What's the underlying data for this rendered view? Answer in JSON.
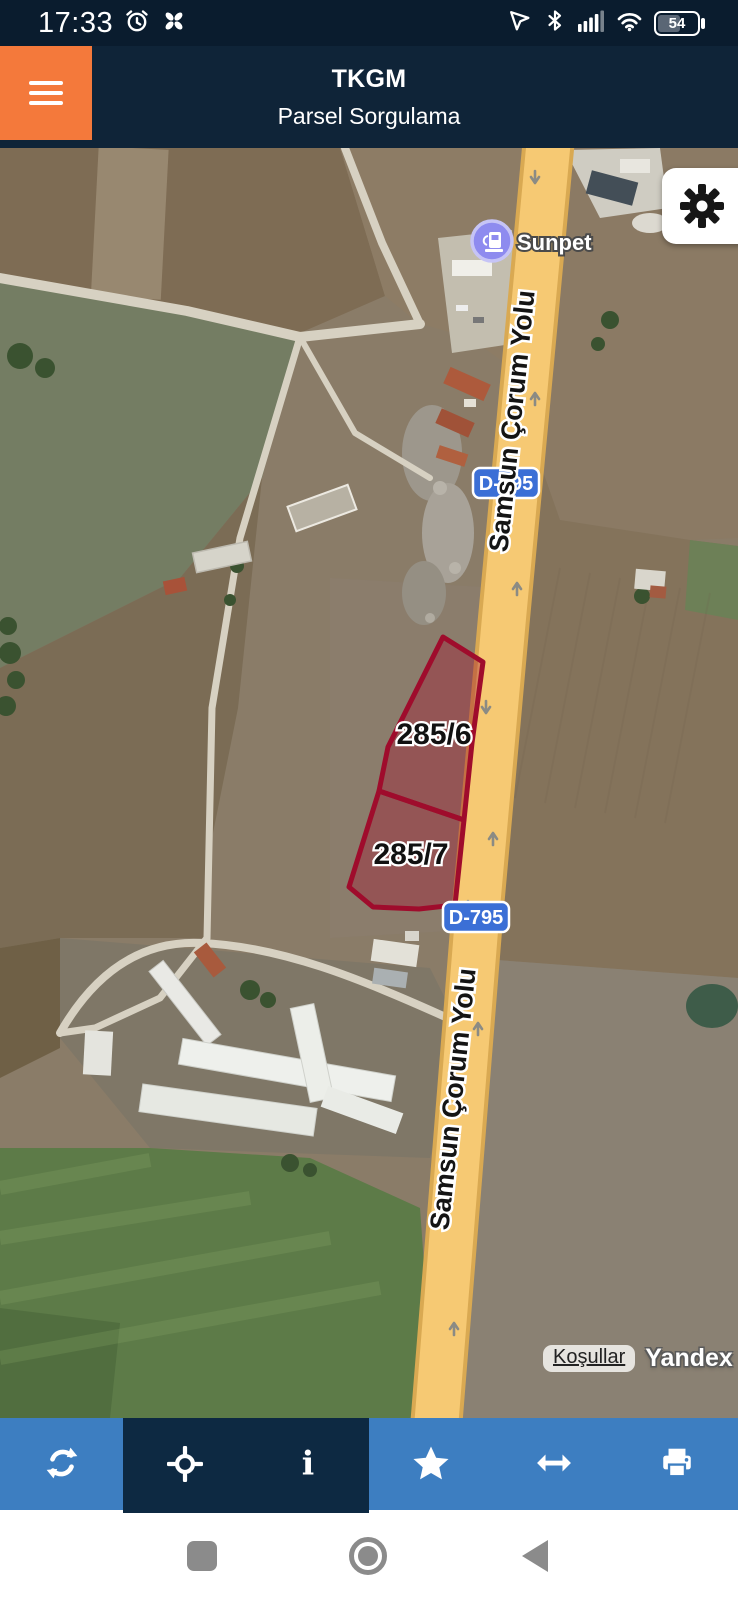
{
  "status_bar": {
    "time": "17:33",
    "battery_level": "54"
  },
  "header": {
    "title": "TKGM",
    "subtitle": "Parsel Sorgulama"
  },
  "map": {
    "poi_label": "Sunpet",
    "road_label": "Samsun Çorum Yolu",
    "route_badge": "D-795",
    "parcels": [
      {
        "id": "285/6"
      },
      {
        "id": "285/7"
      }
    ],
    "attribution": {
      "terms_label": "Koşullar",
      "provider": "Yandex"
    }
  },
  "toolbar": {
    "buttons": [
      {
        "icon": "refresh-icon"
      },
      {
        "icon": "locate-icon"
      },
      {
        "icon": "info-icon"
      },
      {
        "icon": "star-icon"
      },
      {
        "icon": "resize-icon"
      },
      {
        "icon": "print-icon"
      }
    ]
  },
  "colors": {
    "accent_orange": "#F4793B",
    "header_navy": "#0F2438",
    "toolbar_blue": "#3D7EC1",
    "toolbar_dark": "#0D2942",
    "road_yellow": "#F6C973",
    "parcel_red": "#A30C2E",
    "badge_blue": "#3B6FD6",
    "poi_purple": "#8E8BEF"
  }
}
